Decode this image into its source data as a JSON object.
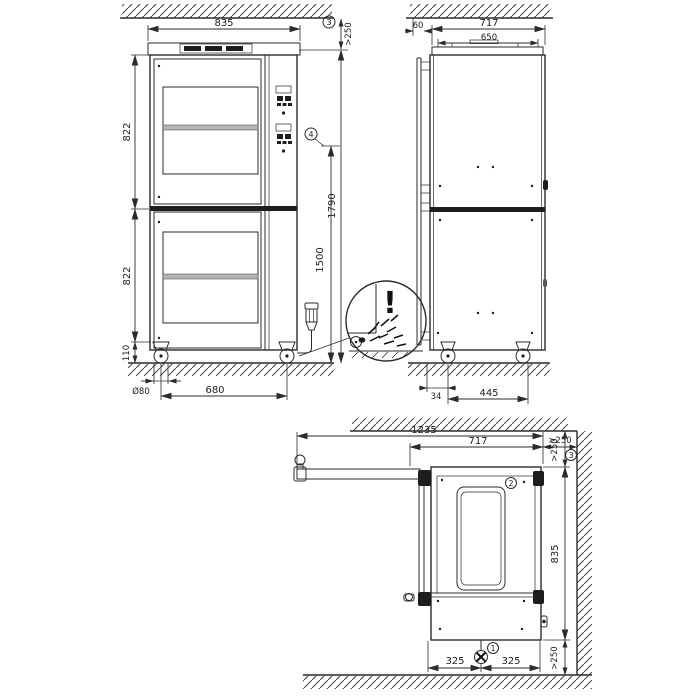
{
  "front_view": {
    "width": "835",
    "ceiling_clearance": ">250",
    "upper_section_height": "822",
    "lower_section_height": "822",
    "base_height": "110",
    "caster_diameter": "Ø80",
    "caster_spacing": "680",
    "total_height": "1790",
    "connection_height": "1500",
    "callout_3": "3",
    "callout_4": "4",
    "warning_mark": "!"
  },
  "side_view": {
    "wall_offset": "60",
    "depth": "717",
    "top_depth": "650",
    "caster_back_offset": "34",
    "caster_spacing": "445"
  },
  "top_view": {
    "door_open_depth": "1235",
    "depth": "717",
    "rear_clearance": ">250",
    "side_clearance_top": ">250",
    "width": "835",
    "drain_offset_left": "325",
    "drain_offset_right": "325",
    "side_clearance_bottom": ">250",
    "callout_1": "1",
    "callout_2": "2",
    "callout_3": "3"
  }
}
